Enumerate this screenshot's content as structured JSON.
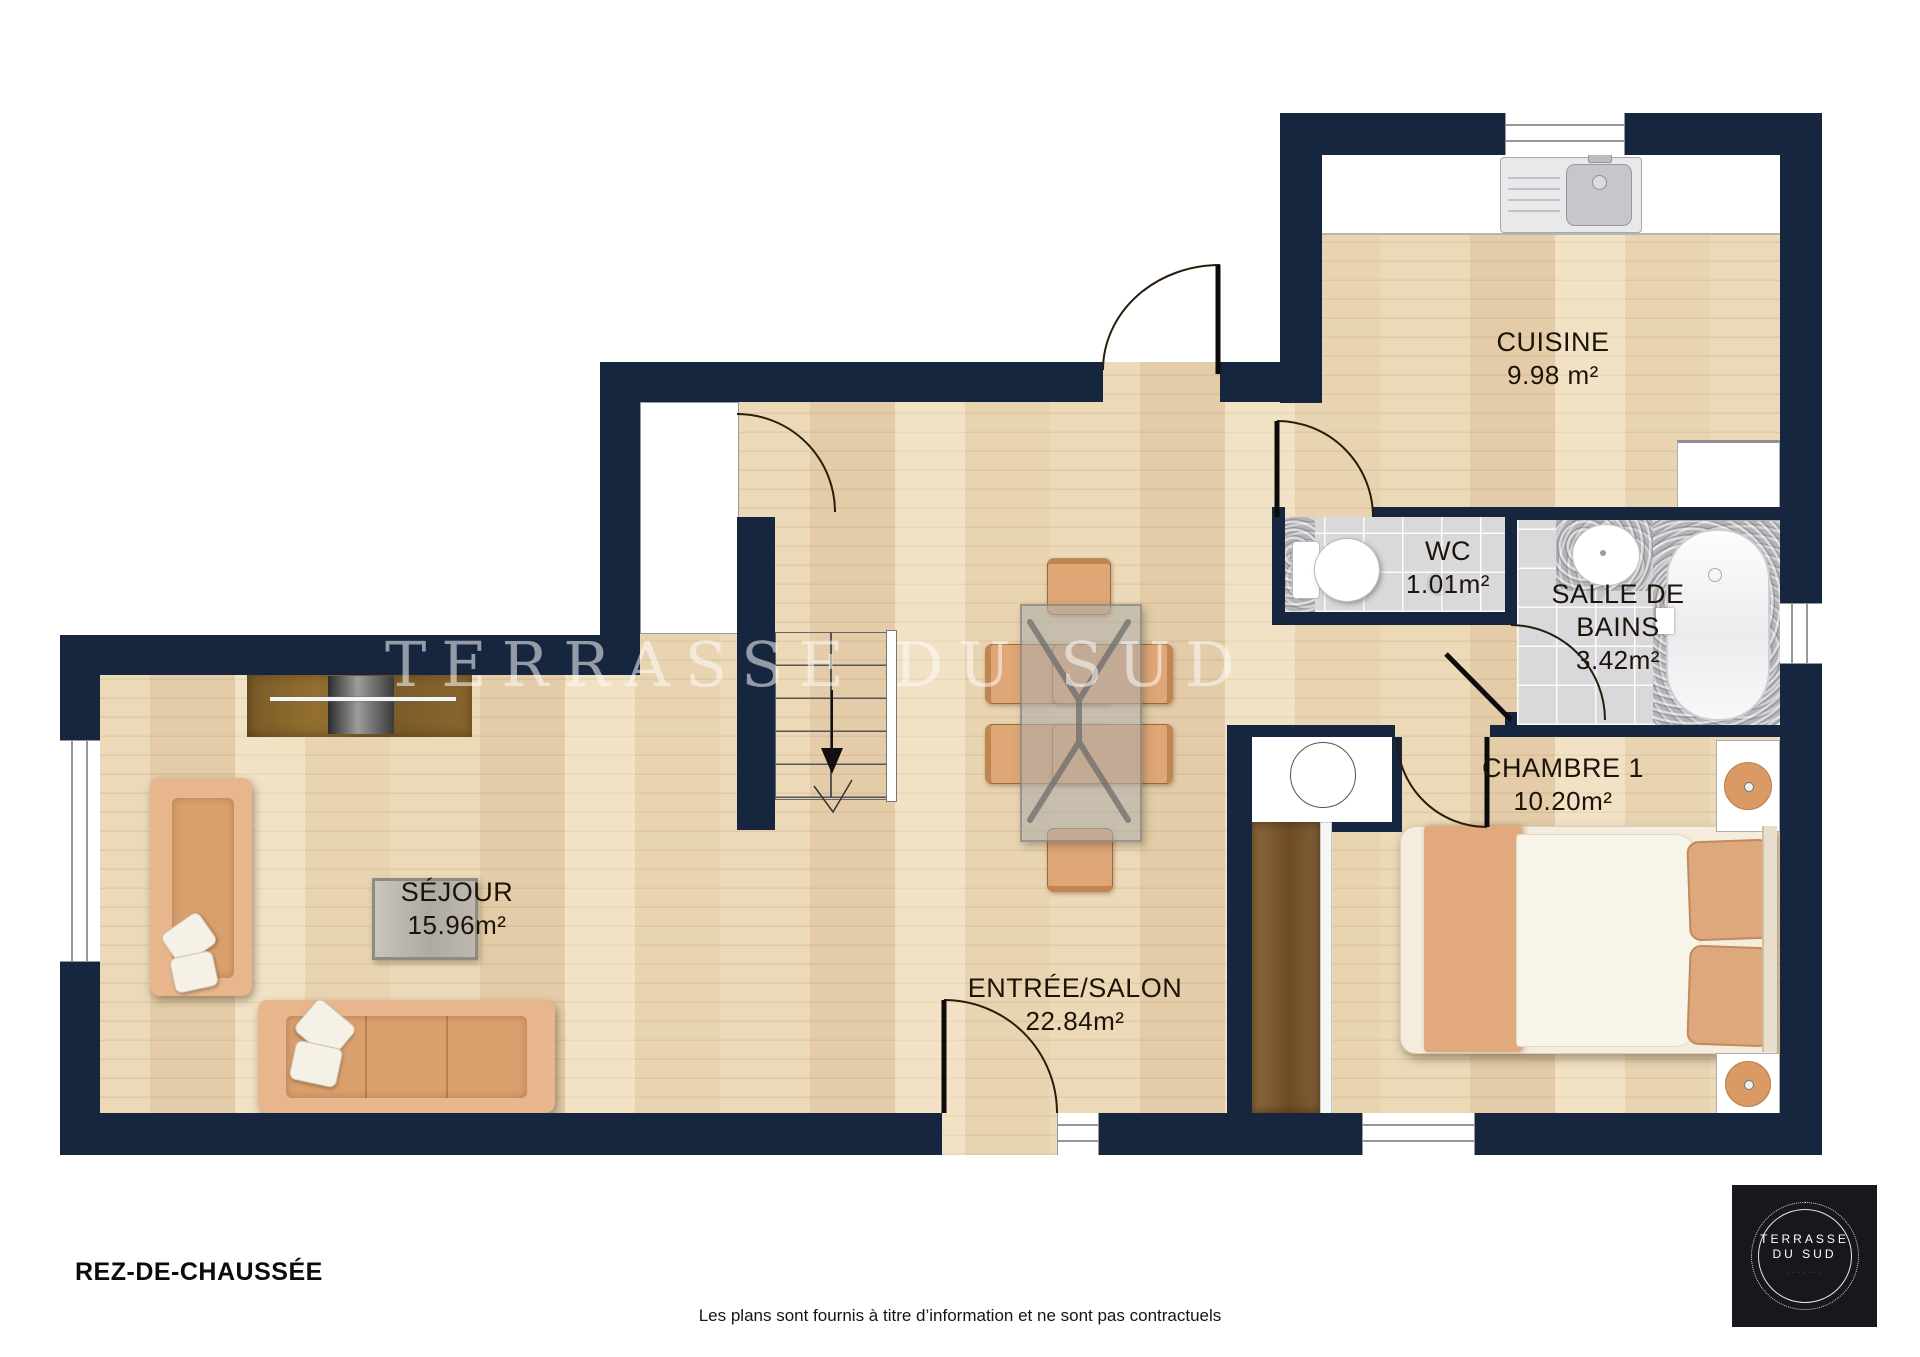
{
  "page": {
    "floor_title": "REZ-DE-CHAUSSÉE",
    "disclaimer": "Les plans sont fournis à titre d’information et ne sont pas contractuels",
    "watermark": "TERRASSE DU SUD"
  },
  "rooms": {
    "cuisine": {
      "name": "CUISINE",
      "area": "9.98 m²"
    },
    "wc": {
      "name": "WC",
      "area": "1.01m²"
    },
    "salle_de_bains": {
      "name": "SALLE DE BAINS",
      "area": "3.42m²"
    },
    "chambre1": {
      "name": "CHAMBRE 1",
      "area": "10.20m²"
    },
    "sejour": {
      "name": "SÉJOUR",
      "area": "15.96m²"
    },
    "entree_salon": {
      "name": "ENTRÉE/SALON",
      "area": "22.84m²"
    }
  },
  "logo": {
    "line1": "TERRASSE",
    "line2": "DU SUD"
  },
  "colors": {
    "wall": "#16263f",
    "floor_wood": "#ecd9b8",
    "tile": "#d9d9dc",
    "sofa": "#e7b68c",
    "cabinet": "#7d5d2b"
  }
}
